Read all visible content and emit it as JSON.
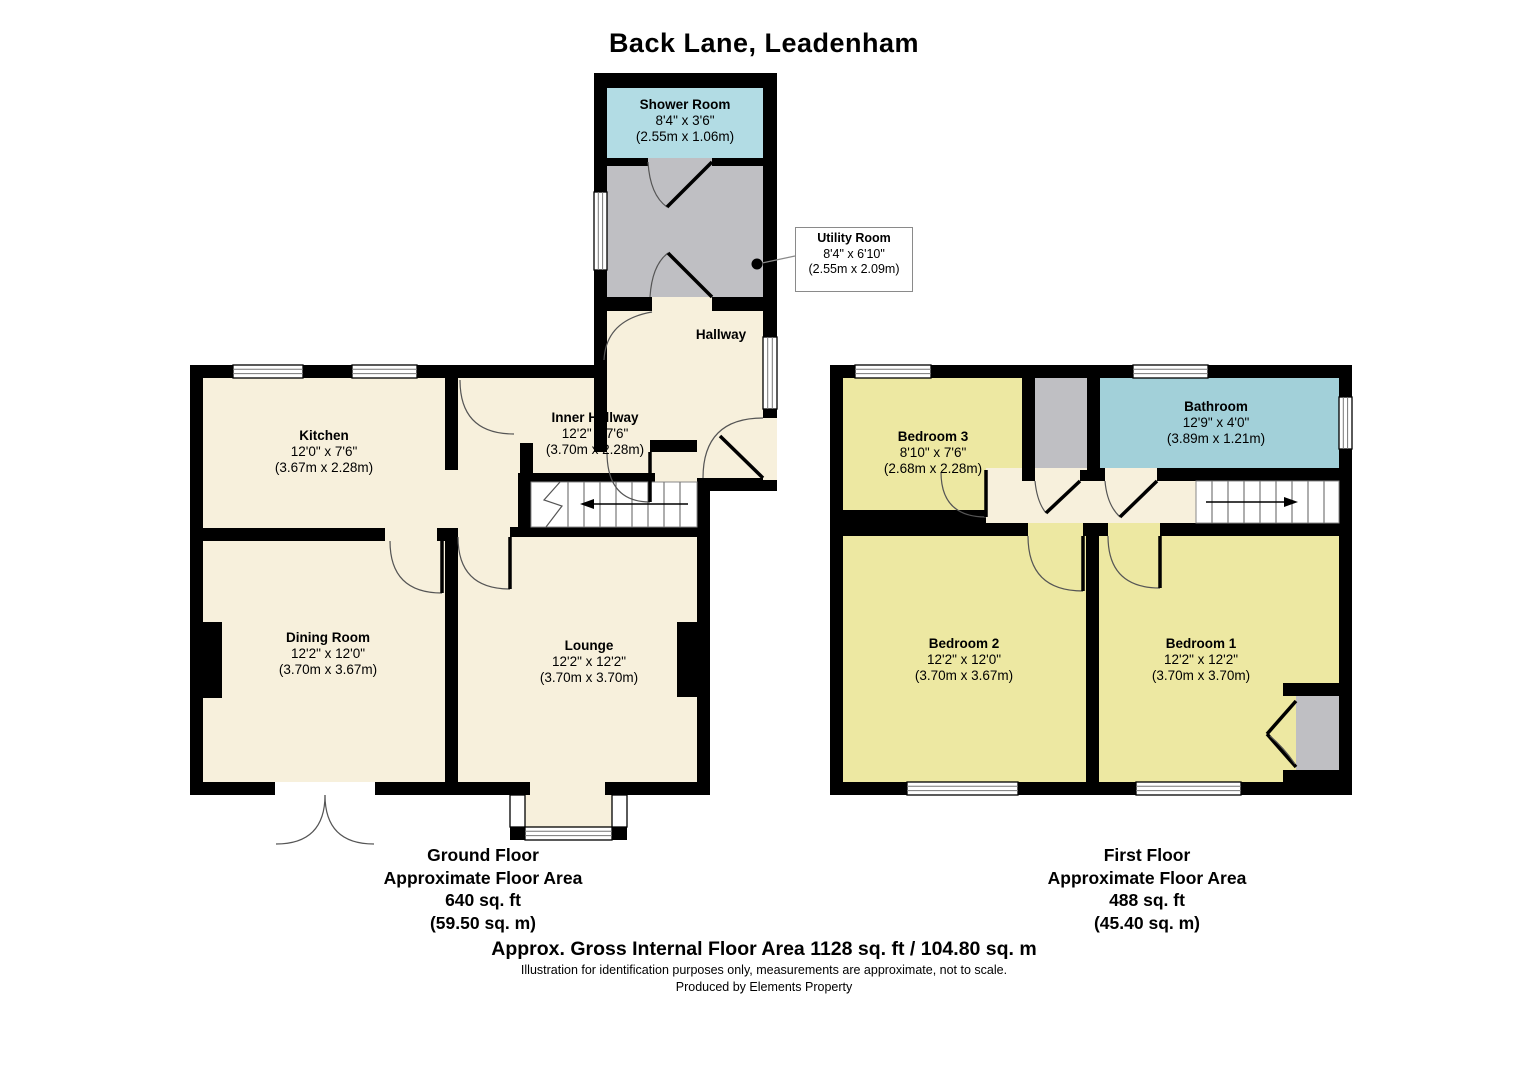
{
  "title": "Back Lane, Leadenham",
  "ground_floor": {
    "caption": {
      "line1": "Ground Floor",
      "line2": "Approximate Floor Area",
      "line3": "640 sq. ft",
      "line4": "(59.50 sq. m)"
    },
    "rooms": {
      "shower_room": {
        "name": "Shower Room",
        "imperial": "8'4\" x 3'6\"",
        "metric": "(2.55m x 1.06m)"
      },
      "utility_room": {
        "name": "Utility Room",
        "imperial": "8'4\" x 6'10\"",
        "metric": "(2.55m x 2.09m)"
      },
      "hallway": {
        "name": "Hallway"
      },
      "inner_hallway": {
        "name": "Inner Hallway",
        "imperial": "12'2\" x 7'6\"",
        "metric": "(3.70m x 2.28m)"
      },
      "kitchen": {
        "name": "Kitchen",
        "imperial": "12'0\" x 7'6\"",
        "metric": "(3.67m x 2.28m)"
      },
      "dining_room": {
        "name": "Dining Room",
        "imperial": "12'2\" x 12'0\"",
        "metric": "(3.70m x 3.67m)"
      },
      "lounge": {
        "name": "Lounge",
        "imperial": "12'2\" x 12'2\"",
        "metric": "(3.70m x 3.70m)"
      }
    }
  },
  "first_floor": {
    "caption": {
      "line1": "First Floor",
      "line2": "Approximate Floor Area",
      "line3": "488 sq. ft",
      "line4": "(45.40 sq. m)"
    },
    "rooms": {
      "bedroom_3": {
        "name": "Bedroom 3",
        "imperial": "8'10\" x 7'6\"",
        "metric": "(2.68m x 2.28m)"
      },
      "bathroom": {
        "name": "Bathroom",
        "imperial": "12'9\" x 4'0\"",
        "metric": "(3.89m x 1.21m)"
      },
      "bedroom_2": {
        "name": "Bedroom 2",
        "imperial": "12'2\" x 12'0\"",
        "metric": "(3.70m x 3.67m)"
      },
      "bedroom_1": {
        "name": "Bedroom 1",
        "imperial": "12'2\" x 12'2\"",
        "metric": "(3.70m x 3.70m)"
      }
    }
  },
  "footer": {
    "gross_area": "Approx. Gross Internal Floor Area 1128 sq. ft / 104.80 sq. m",
    "disclaimer": "Illustration for identification purposes only, measurements are approximate, not to scale.",
    "credit": "Produced by Elements Property"
  },
  "colors": {
    "wall_black": "#000000",
    "floor_cream": "#F7F0DC",
    "bedroom_yellow": "#EDE8A2",
    "shower_blue": "#B2DCE4",
    "bathroom_blue": "#A2D0D9",
    "utility_grey": "#BFBFC3",
    "window_white": "#FFFFFF"
  }
}
